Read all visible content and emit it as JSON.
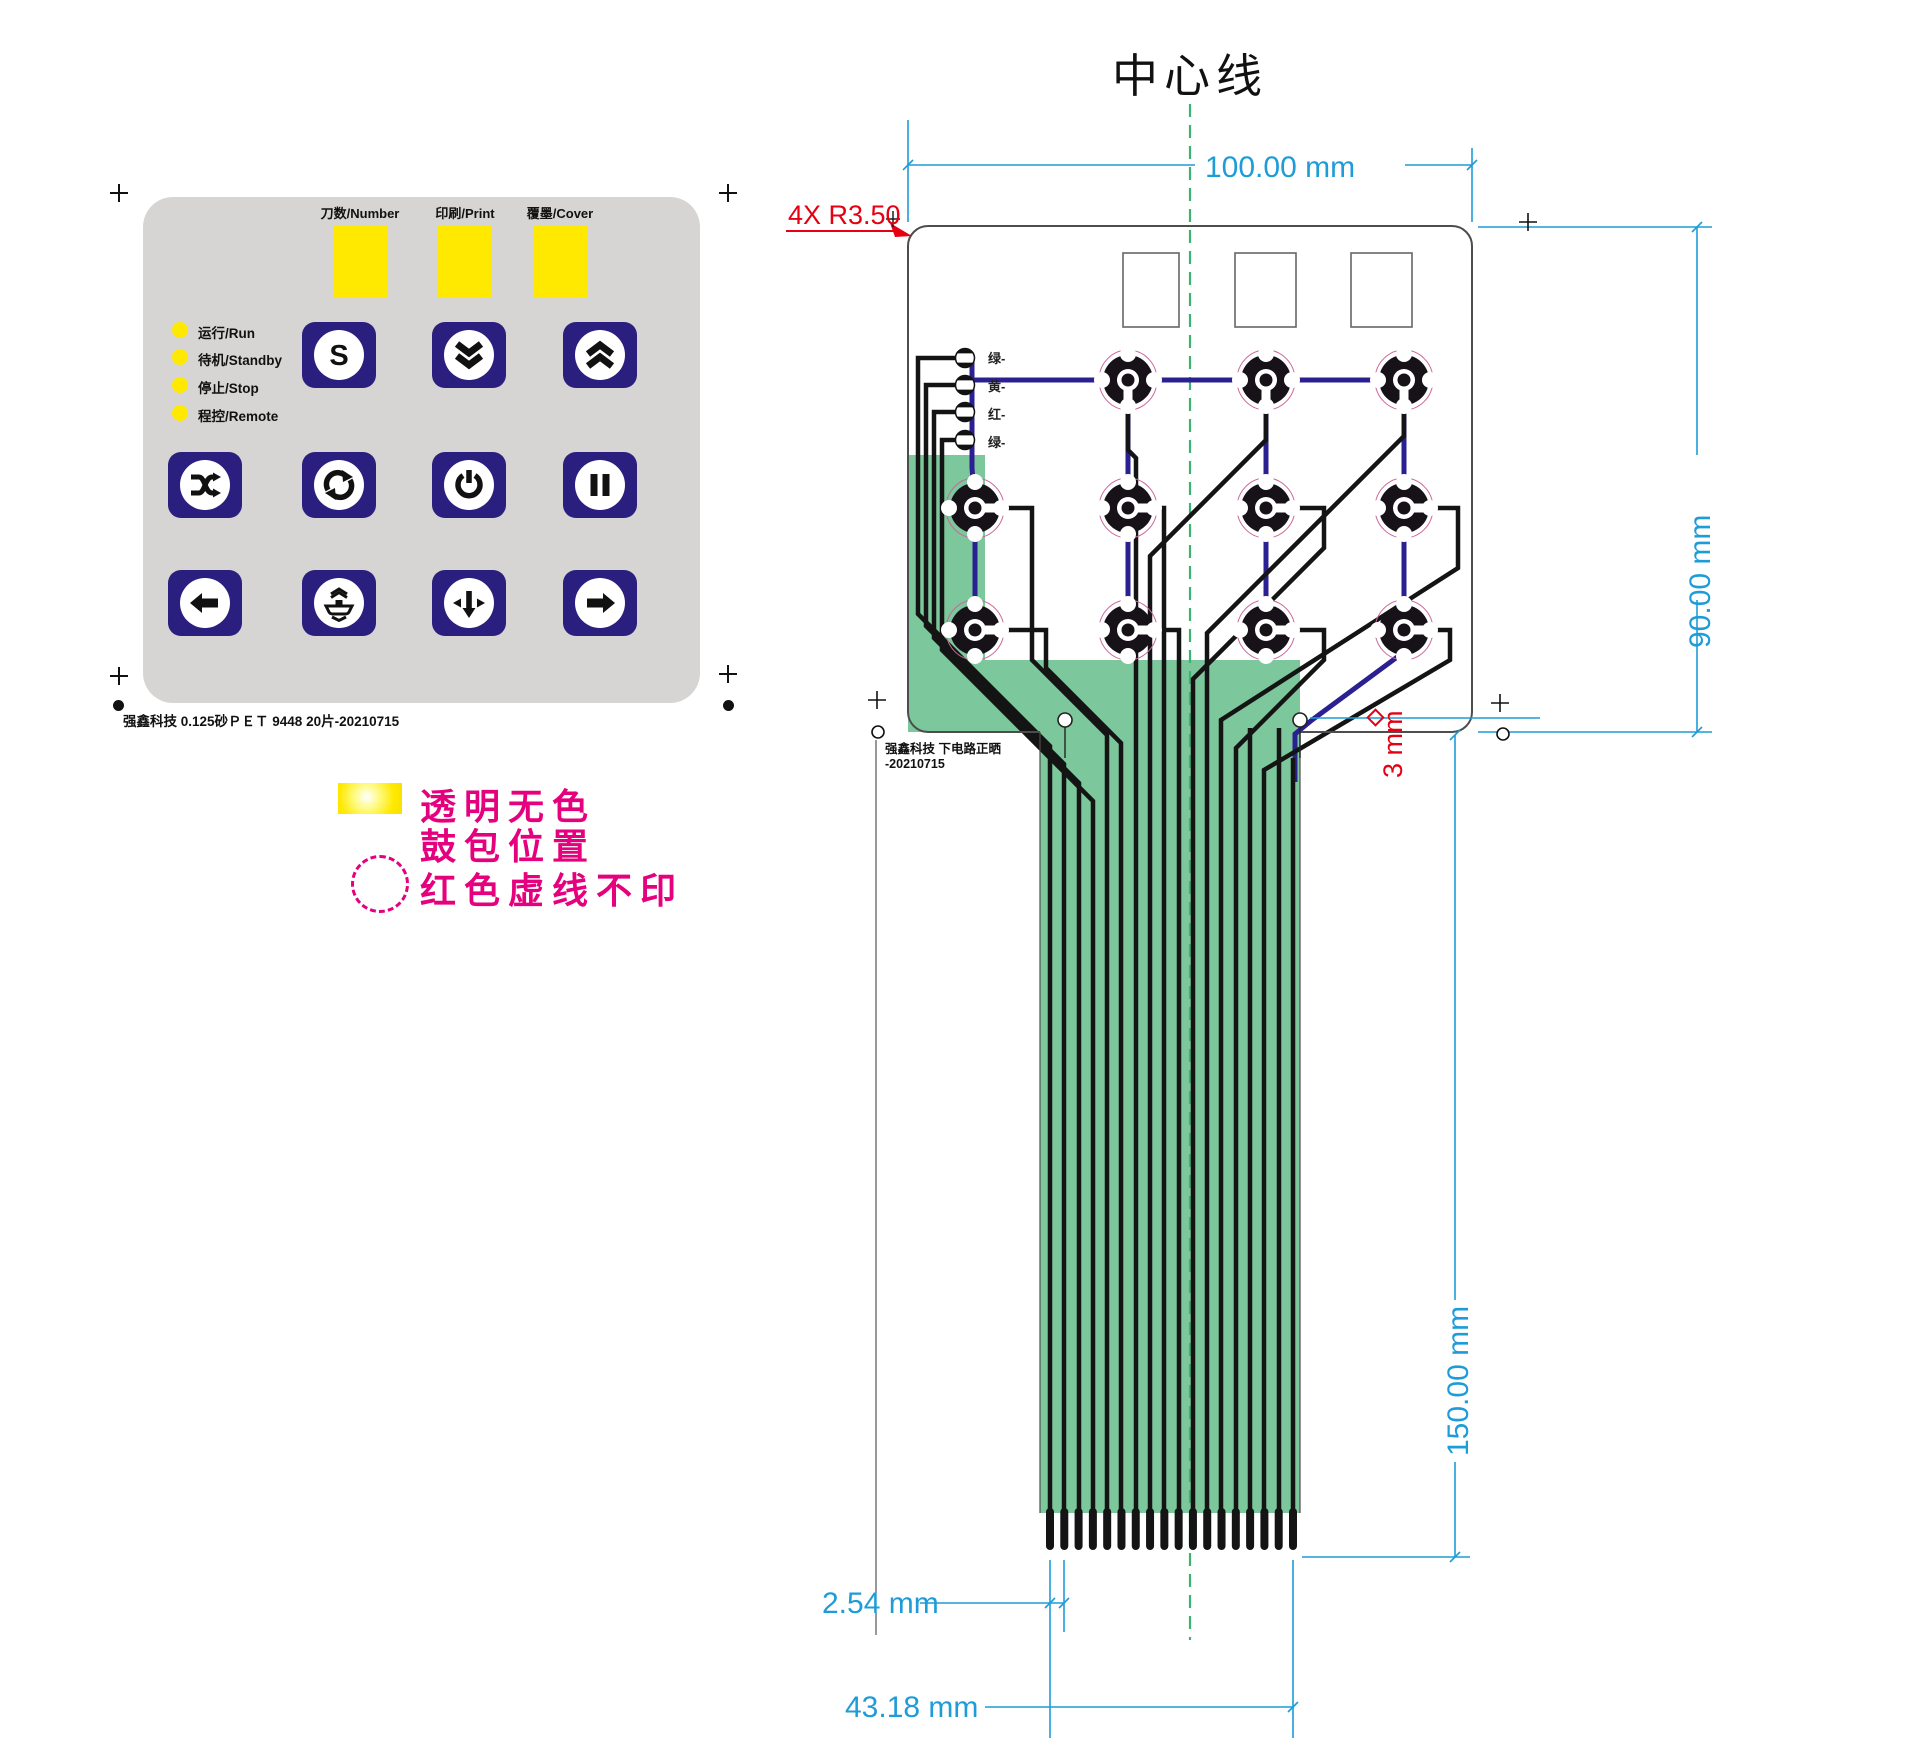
{
  "keypad": {
    "windows": [
      {
        "label": "刀数/Number"
      },
      {
        "label": "印刷/Print"
      },
      {
        "label": "覆墨/Cover"
      }
    ],
    "leds": [
      {
        "label": "运行/Run"
      },
      {
        "label": "待机/Standby"
      },
      {
        "label": "停止/Stop"
      },
      {
        "label": "程控/Remote"
      }
    ],
    "buttons": [
      {
        "icon": "s-mode",
        "glyph": "S"
      },
      {
        "icon": "double-chevron-down"
      },
      {
        "icon": "double-chevron-up"
      },
      {
        "icon": "shuffle"
      },
      {
        "icon": "cycle"
      },
      {
        "icon": "power"
      },
      {
        "icon": "pause"
      },
      {
        "icon": "arrow-left"
      },
      {
        "icon": "sheet-feed"
      },
      {
        "icon": "arrow-down-select"
      },
      {
        "icon": "arrow-right"
      }
    ],
    "footer": "强鑫科技  0.125砂ＰＥＴ  9448  20片-20210715"
  },
  "legend": {
    "line1": "透明无色",
    "line2": "鼓包位置",
    "line3": "红色虚线不印"
  },
  "diagram": {
    "title": "中心线",
    "corner_note": "4X R3.50",
    "led_labels": [
      "绿-",
      "黄-",
      "红-",
      "绿-"
    ],
    "note_line1": "强鑫科技  下电路正晒",
    "note_line2": "-20210715",
    "dimensions": {
      "width": "100.00 mm",
      "height": "90.00 mm",
      "tail_length": "150.00 mm",
      "finger_pitch": "2.54 mm",
      "connector_width": "43.18 mm",
      "hole": "3 mm"
    },
    "tail": {
      "finger_count": 18
    },
    "colors": {
      "dim_blue": "#1e9cd7",
      "note_red": "#e60012",
      "tail_green": "#7cc79b",
      "trace_navy": "#2b2092",
      "legend_magenta": "#e5007e",
      "window_yellow": "#ffe900",
      "center_line_green": "#3cb371"
    }
  }
}
